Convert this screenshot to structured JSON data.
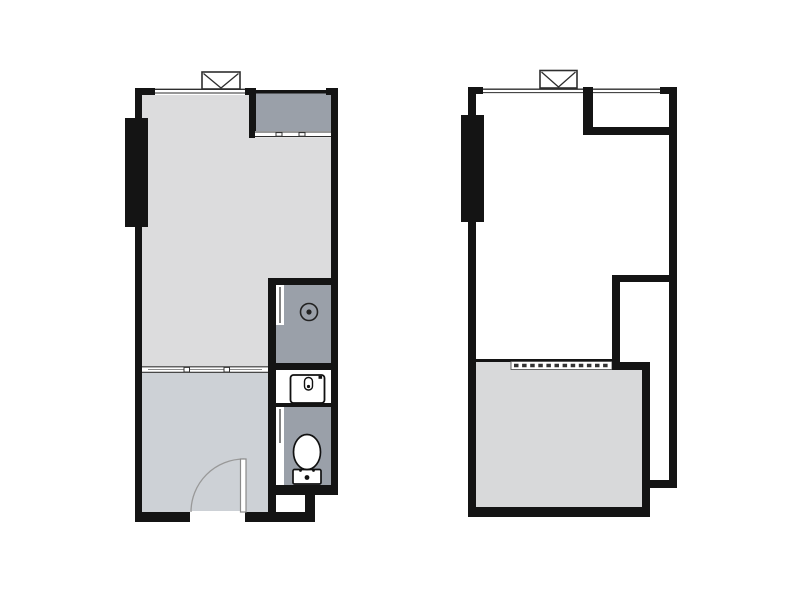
{
  "colors": {
    "background": "#ffffff",
    "wall": "#141414",
    "living_room": "#dcdcdd",
    "bedroom": "#cdd1d6",
    "service_gray": "#9aa0a9",
    "highlight_room": "#d8d9da",
    "window_line": "#2e2e2e",
    "fixture_outline": "#1c1c1c",
    "door_line": "#999999"
  },
  "plans": [
    {
      "id": "plan-detailed",
      "label": "detailed floor plan",
      "rooms": [
        "living-room",
        "bedroom",
        "balcony",
        "kitchen",
        "bathroom"
      ],
      "fixtures": [
        "window",
        "balcony-sliding-door",
        "column",
        "cooktop",
        "sink",
        "toilet",
        "sliding-partition",
        "entry-door"
      ]
    },
    {
      "id": "plan-outline",
      "label": "simplified floor plan",
      "rooms": [
        "main-room",
        "balcony",
        "storage-room",
        "corridor",
        "highlighted-room"
      ],
      "fixtures": [
        "window",
        "column",
        "dashed-partition"
      ]
    }
  ]
}
